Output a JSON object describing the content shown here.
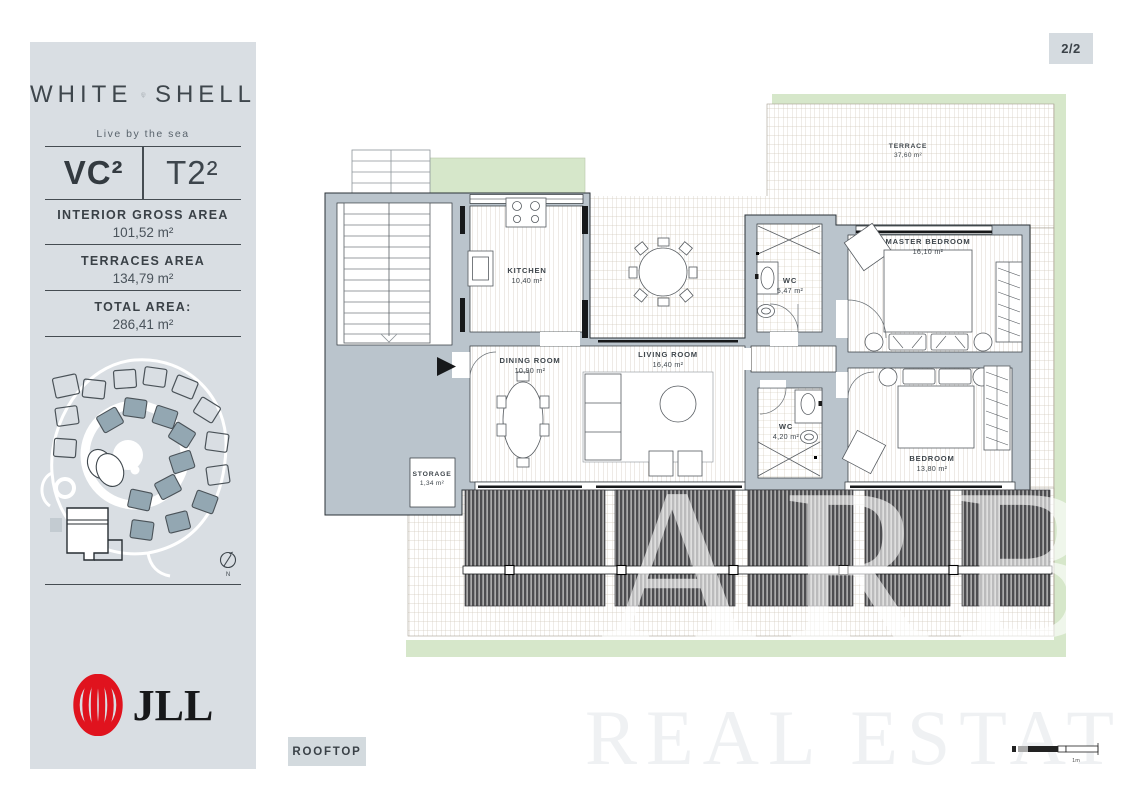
{
  "page": {
    "badge": "2/2",
    "watermark_big": "ARB",
    "watermark_small": "REAL ESTATE"
  },
  "sidebar": {
    "brand": {
      "word_left": "WHITE",
      "word_right": "SHELL",
      "emblem_text": "BEACH VILLAS",
      "tagline": "Live by the sea"
    },
    "unit": {
      "code": "VC²",
      "type": "T2²"
    },
    "areas": [
      {
        "label": "INTERIOR GROSS AREA",
        "value": "101,52 m²"
      },
      {
        "label": "TERRACES AREA",
        "value": "134,79 m²"
      },
      {
        "label": "TOTAL AREA:",
        "value": "286,41 m²"
      }
    ],
    "map": {
      "compass": "N"
    },
    "logo_text": "JLL"
  },
  "plan": {
    "floor_label": "ROOFTOP",
    "scale_label": "1m",
    "rooms": {
      "terrace": {
        "name": "TERRACE",
        "area": "37,60 m²"
      },
      "kitchen": {
        "name": "KITCHEN",
        "area": "10,40 m²"
      },
      "dining": {
        "name": "DINING ROOM",
        "area": "10,90 m²"
      },
      "living": {
        "name": "LIVING ROOM",
        "area": "16,40 m²"
      },
      "wc1": {
        "name": "WC",
        "area": "5,47 m²"
      },
      "master": {
        "name": "MASTER BEDROOM",
        "area": "16,10 m²"
      },
      "wc2": {
        "name": "WC",
        "area": "4,20 m²"
      },
      "bedroom": {
        "name": "BEDROOM",
        "area": "13,80 m²"
      },
      "storage": {
        "name": "STORAGE",
        "area": "1,34 m²"
      }
    }
  },
  "colors": {
    "sidebar_bg": "#d9dee3",
    "panel_bg": "#d3dade",
    "text_dark": "#3b4249",
    "wall_fill": "#bac4cc",
    "green": "#d6e7ca",
    "jll_red": "#e0131e",
    "villa_fill": "#93a7b2"
  }
}
